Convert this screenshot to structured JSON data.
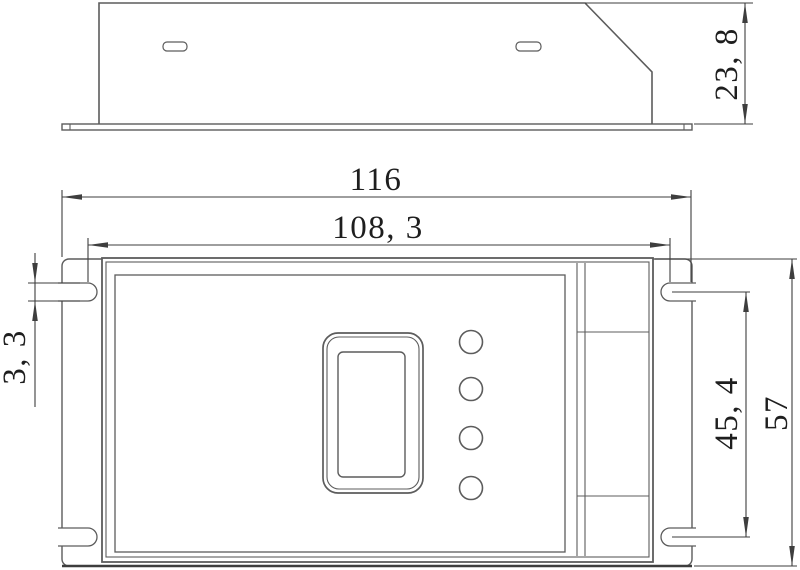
{
  "drawing": {
    "kind": "two-view mechanical outline drawing of an LED controller enclosure",
    "dimensions": {
      "side_height": "23, 8",
      "overall_width": "116",
      "mount_slot_span_width": "108, 3",
      "mount_slot_height": "3, 3",
      "mount_slot_span_height": "45, 4",
      "overall_height": "57"
    },
    "features": {
      "side_view": {
        "vent_slots": 2,
        "base_flange": true
      },
      "plan_view": {
        "mount_slots": 4,
        "buttons": 4,
        "display_window": true
      }
    }
  },
  "colors": {
    "line": "#5c5c5c",
    "line_heavy": "#3d3d3d",
    "dimension": "#3e3e3e",
    "text": "#1e1e1e",
    "background": "#ffffff"
  }
}
